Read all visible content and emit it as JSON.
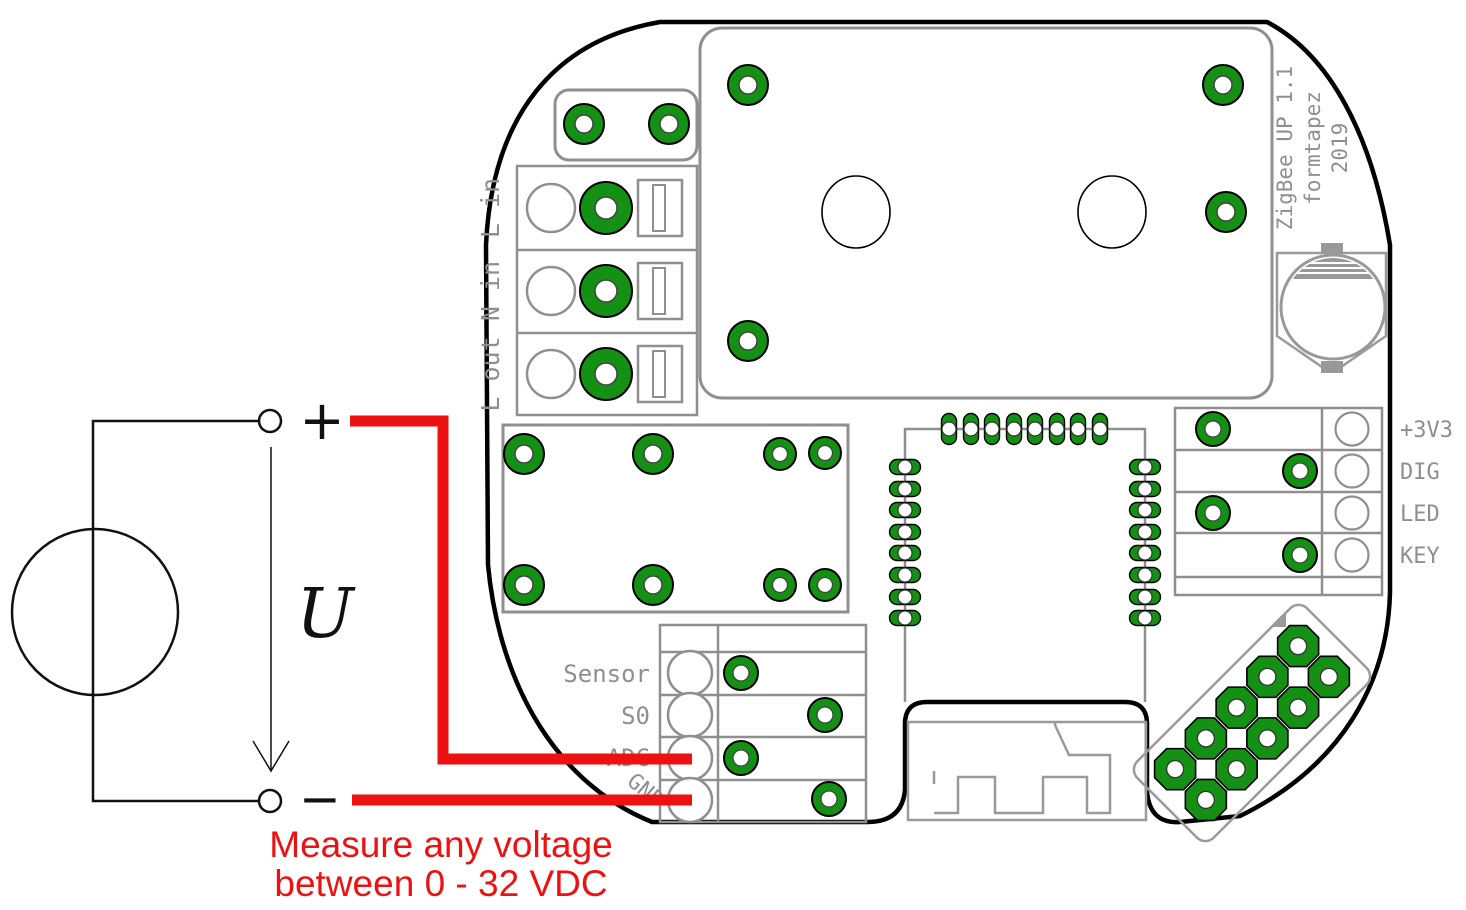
{
  "silkscreen": {
    "title_line1": "ZigBee UP 1.1",
    "title_line2": "formtapez",
    "title_line3": "2019",
    "terminals": {
      "l_in": "L in",
      "n_in": "N in",
      "l_out": "L out"
    },
    "sensor_header": {
      "sensor": "Sensor",
      "s0": "S0",
      "adc": "ADC",
      "gnd": "GND"
    },
    "io_header": {
      "p3v3": "+3V3",
      "dig": "DIG",
      "led": "LED",
      "key": "KEY"
    }
  },
  "circuit": {
    "plus": "+",
    "minus": "−",
    "voltage_label": "U"
  },
  "annotation": {
    "line1": "Measure any voltage",
    "line2": "between 0 - 32 VDC"
  },
  "colors": {
    "pad_green": "#149014",
    "wire_red": "#ee1111",
    "outline_gray": "#8f8f8f",
    "board_outline": "#000000",
    "silk_text": "#8f8f8f"
  }
}
